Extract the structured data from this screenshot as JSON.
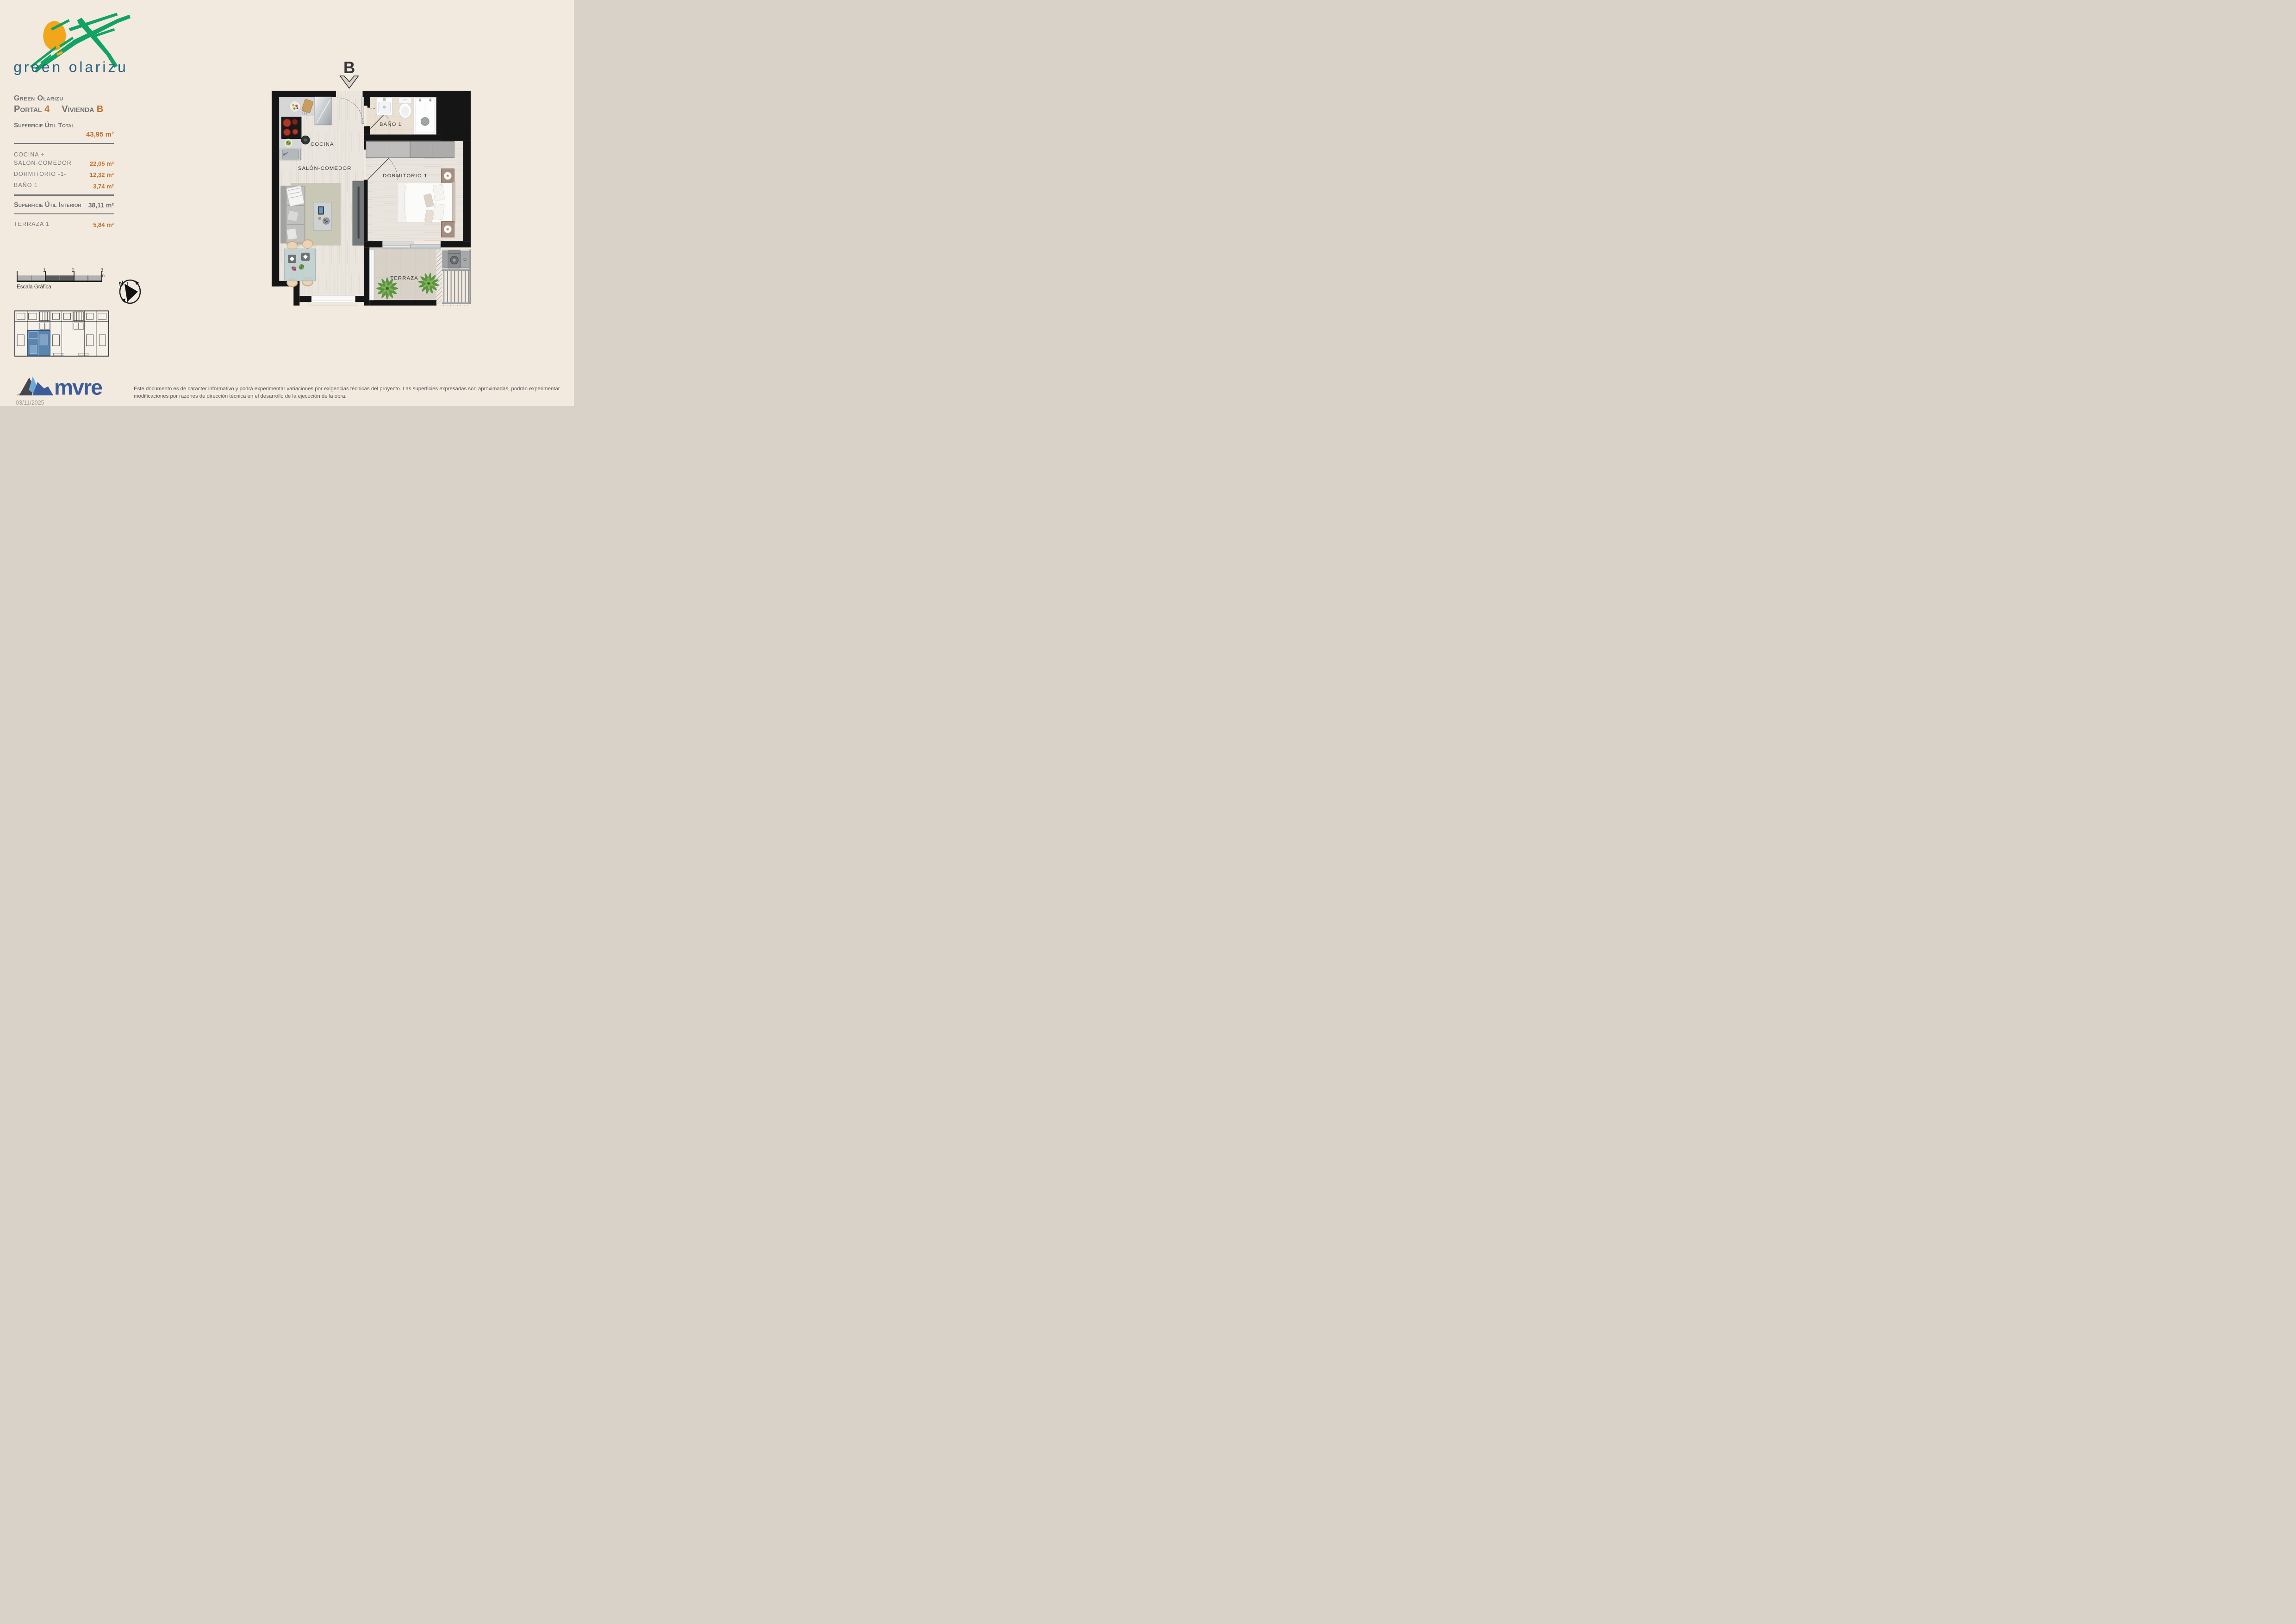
{
  "page": {
    "background": "#f3eadf"
  },
  "brand_logo": {
    "title": "green olarizu",
    "green": "#12a263",
    "sun_orange": "#f2a71b",
    "title_color": "#25617f"
  },
  "unit_panel": {
    "project_name": "Green Olarizu",
    "portal_label": "Portal ",
    "portal_number": "4",
    "vivienda_label": "Vivienda ",
    "vivienda_letter": "B",
    "total_area_label": "Superficie Útil Total",
    "total_area_value": "43,95 m²",
    "rooms": [
      {
        "line1": "COCINA +",
        "line2": "SALON-COMEDOR",
        "value": "22,05 m²"
      },
      {
        "line1": "DORMITORIO -1-",
        "value": "12,32 m²"
      },
      {
        "line1": "BAÑO 1",
        "value": "3,74 m²"
      }
    ],
    "interior_area_label": "Superficie Útil Interior",
    "interior_area_value": "38,11 m²",
    "terrace_label": "TERRAZA 1",
    "terrace_value": "5,84 m²",
    "accent_orange": "#c0702f",
    "text_gray": "#6d6e70"
  },
  "floor_plan": {
    "entrance_label": "B",
    "room_labels": {
      "kitchen": "COCINA",
      "living": "SALÓN-COMEDOR",
      "bath": "BAÑO 1",
      "bedroom": "DORMITORIO 1",
      "terrace": "TERRAZA"
    }
  },
  "scale_bar": {
    "title": "Escala Gráfica",
    "tick_1": "1",
    "tick_2": "2",
    "tick_3": "3 m."
  },
  "compass": {
    "north": "N"
  },
  "key_plan": {
    "highlight_color": "#5b85ae"
  },
  "footer": {
    "brand": "mvre",
    "date": "03/11/2025",
    "disclaimer": "Este documento es de caracter informativo y podrá experimentar variaciones por exigencias técnicas del proyecto. Las superficies expresadas son aproximadas, podrán experimentar modificaciones por razones de dirección técnica en el desarrollo de la ejecución de la obra."
  }
}
